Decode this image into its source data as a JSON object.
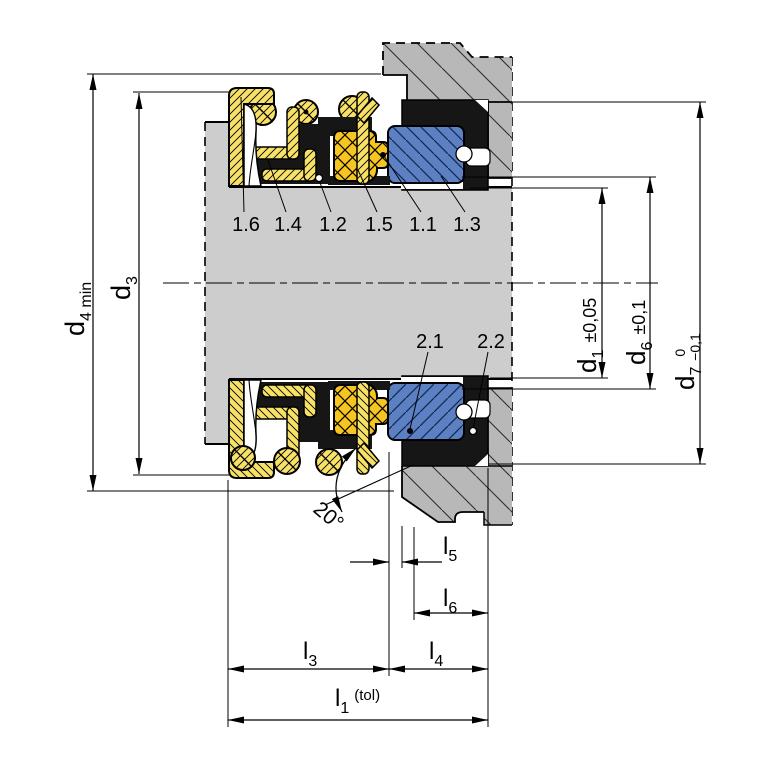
{
  "drawing": {
    "kind": "mechanical-seal-cross-section"
  },
  "callouts": {
    "upper": [
      "1.6",
      "1.4",
      "1.2",
      "1.5",
      "1.1",
      "1.3"
    ],
    "lower": [
      "2.1",
      "2.2"
    ]
  },
  "dimensions": {
    "d4": {
      "base": "d",
      "sub": "4 min"
    },
    "d3": {
      "base": "d",
      "sub": "3"
    },
    "d1": {
      "base": "d",
      "sub": "1",
      "tol": "±0,05"
    },
    "d6": {
      "base": "d",
      "sub": "6",
      "tol": "±0,1"
    },
    "d7": {
      "base": "d",
      "sub": "7",
      "tol_upper": "0",
      "tol_lower": "−0,1"
    },
    "l5": {
      "base": "l",
      "sub": "5"
    },
    "l6": {
      "base": "l",
      "sub": "6"
    },
    "l3": {
      "base": "l",
      "sub": "3"
    },
    "l4": {
      "base": "l",
      "sub": "4"
    },
    "l1": {
      "base": "l",
      "sub": "1",
      "tol": "(tol)"
    },
    "angle": "20°"
  },
  "colors": {
    "background": "#ffffff",
    "shaft_gray": "#cdcdcd",
    "housing_gray": "#b8b8b8",
    "metal_yellow": "#f8e167",
    "carbon_gold": "#f6c51f",
    "seat_blue": "#5d80c2",
    "seat_hatch": "#0e2a55",
    "rubber_black": "#161616",
    "line_black": "#000000"
  }
}
